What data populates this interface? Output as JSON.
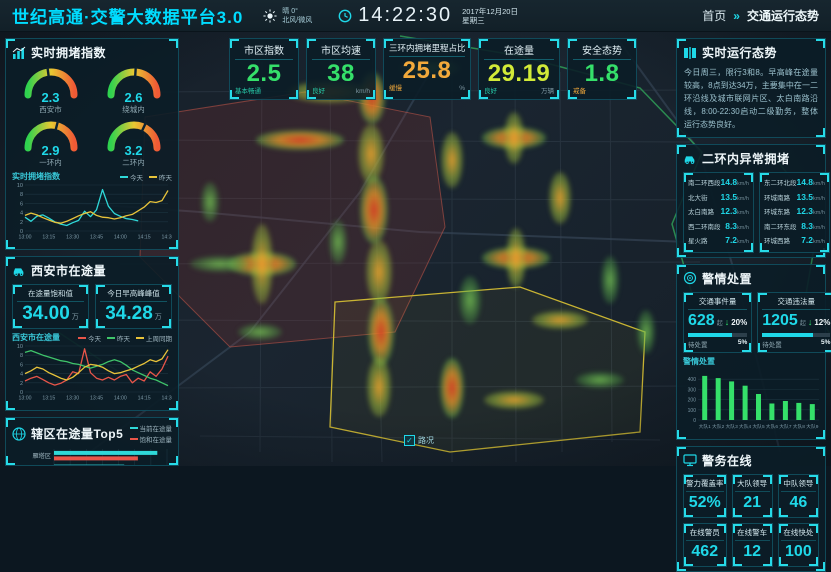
{
  "header": {
    "title": "世纪高通·交警大数据平台3.0",
    "weather": {
      "condition": "晴 0°",
      "wind": "北风/微风"
    },
    "time": "14:22:30",
    "date": "2017年12月20日",
    "weekday": "星期三",
    "nav_home": "首页",
    "nav_sep": "»",
    "nav_current": "交通运行态势"
  },
  "kpis": [
    {
      "label": "市区指数",
      "value": "2.5",
      "status": "基本畅通",
      "unit": ""
    },
    {
      "label": "市区均速",
      "value": "38",
      "status": "良好",
      "unit": "km/h"
    },
    {
      "label": "三环内拥堵里程占比",
      "value": "25.8",
      "status": "缓慢",
      "unit": "%"
    },
    {
      "label": "在途量",
      "value": "29.19",
      "status": "良好",
      "unit": "万辆"
    },
    {
      "label": "安全态势",
      "value": "1.8",
      "status": "戒备",
      "unit": ""
    }
  ],
  "left": {
    "congestion": {
      "title": "实时拥堵指数",
      "gauges": [
        {
          "value": "2.3",
          "label": "西安市"
        },
        {
          "value": "2.6",
          "label": "绕城内"
        },
        {
          "value": "2.9",
          "label": "一环内"
        },
        {
          "value": "3.2",
          "label": "二环内"
        }
      ]
    },
    "onroad": {
      "title": "西安市在途量",
      "stats": [
        {
          "label": "在途量饱和值",
          "value": "34.00",
          "unit": "万"
        },
        {
          "label": "今日早高峰峰值",
          "value": "34.28",
          "unit": "万"
        }
      ]
    },
    "top5": {
      "title": "辖区在途量Top5"
    }
  },
  "right": {
    "status": {
      "title": "实时运行态势",
      "text": "今日周三，限行3和8。早高峰在途量较高，8点到达34万，主要集中在一二环沿线及城市联网片区、太白南路沿线，8:00-22:30启动二级勤务，整体运行态势良好。"
    },
    "abnormal": {
      "title": "二环内异常拥堵",
      "unit": "km/h",
      "left_col": [
        {
          "road": "南二环西段",
          "speed": "14.8"
        },
        {
          "road": "北大街",
          "speed": "13.5"
        },
        {
          "road": "太白南路",
          "speed": "12.3"
        },
        {
          "road": "西二环南段",
          "speed": "8.3"
        },
        {
          "road": "星火路",
          "speed": "7.2"
        }
      ],
      "right_col": [
        {
          "road": "东二环北段",
          "speed": "14.8"
        },
        {
          "road": "环城南路",
          "speed": "13.5"
        },
        {
          "road": "环城东路",
          "speed": "12.3"
        },
        {
          "road": "南二环东段",
          "speed": "8.3"
        },
        {
          "road": "环城西路",
          "speed": "7.2"
        }
      ]
    },
    "incidents": {
      "title": "警情处置",
      "chart_label": "警情处置",
      "cards": [
        {
          "label": "交通事件量",
          "value": "628",
          "unit": "起",
          "delta": "20%",
          "pending_label": "待处置",
          "pending_value": "5%",
          "progress": 0.75
        },
        {
          "label": "交通违法量",
          "value": "1205",
          "unit": "起",
          "delta": "12%",
          "pending_label": "待处置",
          "pending_value": "5%",
          "progress": 0.75
        }
      ]
    },
    "police": {
      "title": "警务在线",
      "cards": [
        {
          "label": "警力覆盖率",
          "value": "52%"
        },
        {
          "label": "大队领导",
          "value": "21"
        },
        {
          "label": "中队领导",
          "value": "46"
        },
        {
          "label": "在线警员",
          "value": "462"
        },
        {
          "label": "在线警车",
          "value": "12"
        },
        {
          "label": "在线快处",
          "value": "100"
        }
      ]
    }
  },
  "map": {
    "toggle_label": "路况"
  },
  "chart_data": [
    {
      "id": "congestion_trend",
      "type": "line",
      "title": "实时拥堵指数",
      "x": [
        "13:00",
        "13:15",
        "13:30",
        "13:45",
        "14:00",
        "14:15",
        "14:30"
      ],
      "ylim": [
        0,
        10
      ],
      "yticks": [
        0,
        2,
        4,
        6,
        8,
        10
      ],
      "legend_position": "top-right",
      "series": [
        {
          "name": "今天",
          "color": "#2fd8d8",
          "values": [
            3.0,
            2.1,
            3.2,
            3.5,
            2.8,
            2.0,
            1.5,
            1.2,
            1.8,
            2.3,
            4.3,
            3.1,
            4.6,
            9.0,
            5.4,
            3.8,
            3.2,
            2.7,
            2.5,
            2.2,
            null,
            null,
            null,
            null,
            null
          ]
        },
        {
          "name": "昨天",
          "color": "#e8c33a",
          "values": [
            3.4,
            3.9,
            3.5,
            2.9,
            2.4,
            1.9,
            1.7,
            2.1,
            2.7,
            3.3,
            3.8,
            4.2,
            3.4,
            3.0,
            2.9,
            2.6,
            2.9,
            3.3,
            3.6,
            4.4,
            5.2,
            6.4,
            6.2,
            6.6,
            8.8
          ]
        }
      ]
    },
    {
      "id": "onroad_trend",
      "type": "line",
      "title": "西安市在途量",
      "x": [
        "13:00",
        "13:15",
        "13:30",
        "13:45",
        "14:00",
        "14:15",
        "14:30"
      ],
      "ylim": [
        0,
        10
      ],
      "yticks": [
        0,
        2,
        4,
        6,
        8,
        10
      ],
      "legend_position": "top-right",
      "series": [
        {
          "name": "今天",
          "color": "#e85549",
          "values": [
            2.4,
            3.0,
            3.4,
            2.7,
            2.0,
            1.5,
            1.9,
            2.6,
            4.4,
            4.0,
            9.4,
            4.2,
            3.0,
            2.6,
            3.2,
            2.6,
            3.4,
            3.8,
            2.0,
            3.0,
            2.4,
            4.4,
            3.4,
            5.0,
            7.8
          ]
        },
        {
          "name": "昨天",
          "color": "#3fc46a",
          "values": [
            8.6,
            9.0,
            8.5,
            8.0,
            7.6,
            7.2,
            6.8,
            6.6,
            6.2,
            6.0,
            5.6,
            5.2,
            5.6,
            6.0,
            6.6,
            7.0,
            6.6,
            5.8,
            4.8,
            4.2,
            3.6,
            3.0,
            2.6,
            2.0,
            1.4
          ]
        },
        {
          "name": "上周同期",
          "color": "#e8c33a",
          "values": [
            4.0,
            4.6,
            5.4,
            5.0,
            4.2,
            3.6,
            3.0,
            2.6,
            3.2,
            4.2,
            5.4,
            6.0,
            5.8,
            5.4,
            4.6,
            4.0,
            4.2,
            4.6,
            5.0,
            5.6,
            6.2,
            7.0,
            6.6,
            7.2,
            9.2
          ]
        }
      ]
    },
    {
      "id": "district_top5",
      "type": "bar-horizontal",
      "title": "辖区在途量Top5",
      "categories": [
        "雁塔区",
        "未央区",
        "莲湖区",
        "浐灞生态区"
      ],
      "xlim": [
        0,
        14
      ],
      "xticks": [
        0,
        2,
        4,
        6,
        8,
        10,
        12,
        14
      ],
      "series": [
        {
          "name": "当前在途量",
          "color": "#2fd8d8",
          "values": [
            12.8,
            8.7,
            6.6,
            4.2
          ]
        },
        {
          "name": "饱和在途量",
          "color": "#e85549",
          "values": [
            10.4,
            8.5,
            7.2,
            3.8
          ]
        }
      ]
    },
    {
      "id": "incident_by_district",
      "type": "bar",
      "title": "警情处置",
      "categories": [
        "大队1",
        "大队2",
        "大队3",
        "大队4",
        "大队5",
        "大队6",
        "大队7",
        "大队8",
        "大队9"
      ],
      "ylim": [
        0,
        480
      ],
      "yticks": [
        0,
        100,
        200,
        300,
        400
      ],
      "series": [
        {
          "name": "警情量",
          "color": "#35e06a",
          "values": [
            432,
            410,
            378,
            336,
            255,
            162,
            186,
            168,
            156
          ]
        }
      ]
    }
  ]
}
